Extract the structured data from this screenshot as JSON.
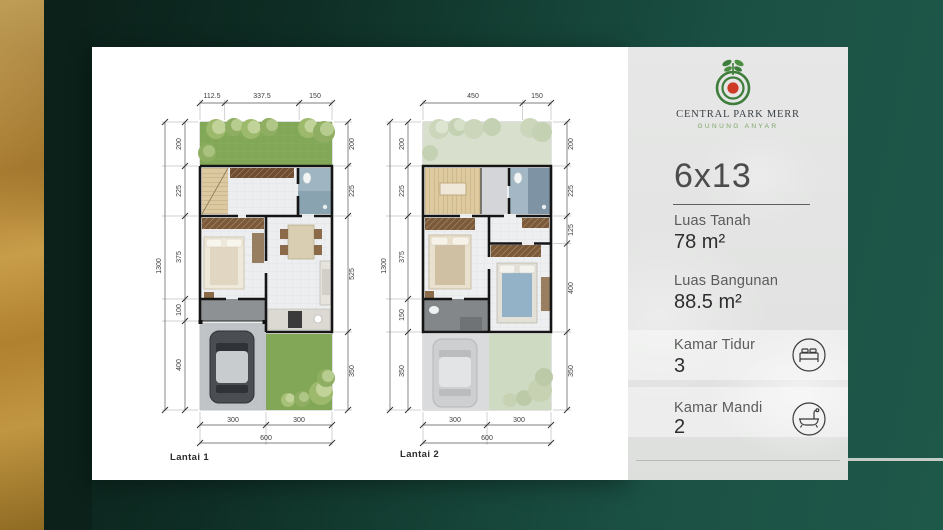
{
  "brand": {
    "name": "CENTRAL PARK MERR",
    "location": "GUNUNG ANYAR"
  },
  "unit": {
    "size": "6x13"
  },
  "details": {
    "items": [
      {
        "label": "Luas Tanah",
        "value": "78 m²"
      },
      {
        "label": "Luas Bangunan",
        "value": "88.5 m²"
      },
      {
        "label": "Kamar Tidur",
        "value": "3",
        "icon": "bed-icon"
      },
      {
        "label": "Kamar Mandi",
        "value": "2",
        "icon": "bathtub-icon"
      }
    ]
  },
  "plans": [
    {
      "label": "Lantai 1",
      "dims": {
        "top": [
          "112.5",
          "337.5",
          "150"
        ],
        "left": [
          "200",
          "225",
          "375",
          "100",
          "400"
        ],
        "left_total": "1300",
        "right": [
          "200",
          "225",
          "525",
          "350"
        ],
        "bottom": [
          "300",
          "300"
        ],
        "bottom_total": "600"
      }
    },
    {
      "label": "Lantai 2",
      "dims": {
        "top": [
          "450",
          "150"
        ],
        "left": [
          "200",
          "225",
          "375",
          "150",
          "350"
        ],
        "left_total": "1300",
        "right": [
          "200",
          "225",
          "125",
          "400",
          "350"
        ],
        "bottom": [
          "300",
          "300"
        ],
        "bottom_total": "600"
      }
    }
  ],
  "colors": {
    "background_green": "#1d5748",
    "background_dark": "#0b211a",
    "gold": "#bd8f3e",
    "panel_gray": "#e3e4e3",
    "logo_green": "#3e7d3a",
    "logo_red": "#cf3a26",
    "grass_green": "#82a857",
    "accent_text": "#4c4c4c"
  }
}
